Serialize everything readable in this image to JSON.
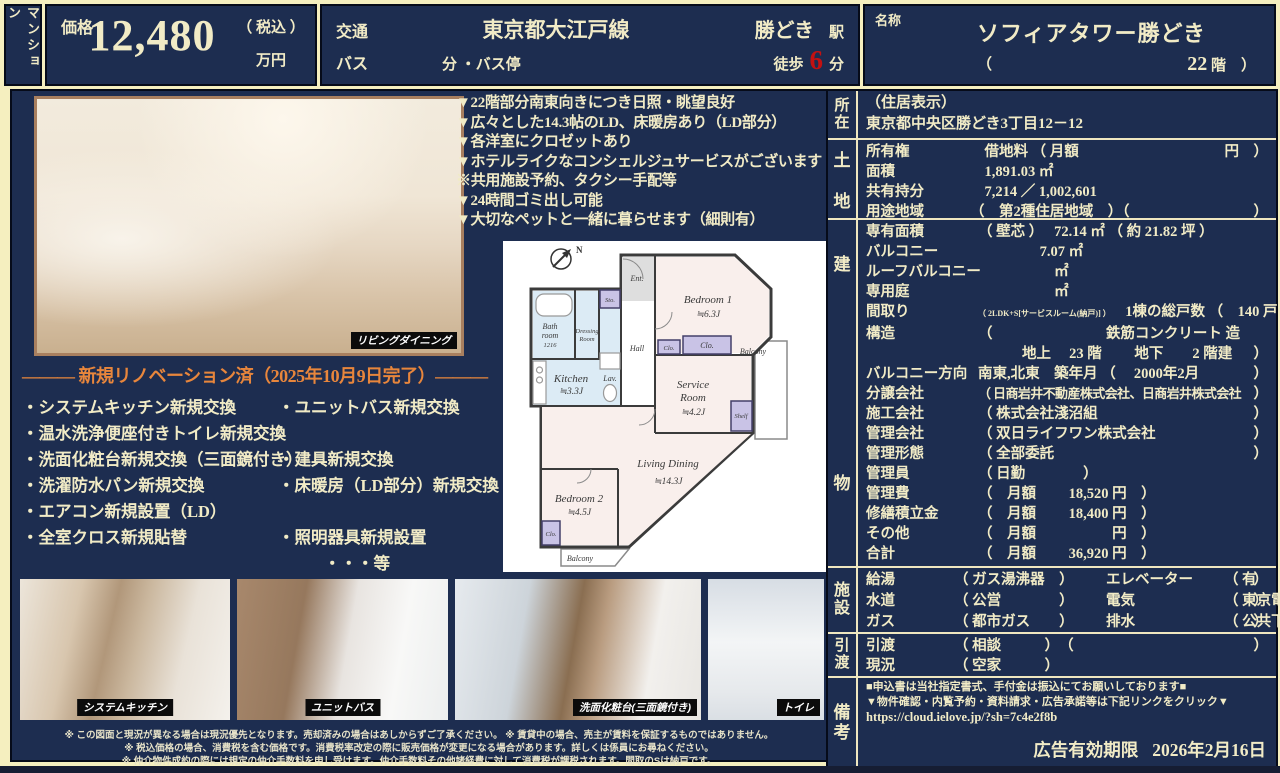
{
  "header": {
    "type_label": "マンション",
    "price": {
      "label": "価格",
      "value": "12,480",
      "tax": "（ 税込 ）",
      "unit": "万円"
    },
    "transport": {
      "label": "交通",
      "line": "東京都大江戸線",
      "station": "勝どき",
      "station_unit": "駅",
      "bus_label": "バス",
      "bus_tail": "分 ・バス停",
      "walk_label": "徒歩",
      "walk_value": "6",
      "walk_unit": "分"
    },
    "name": {
      "label": "名称",
      "value": "ソフィアタワー勝どき",
      "floor_open": "（",
      "floor_value": "22",
      "floor_unit": "階",
      "floor_close": "）"
    }
  },
  "features": [
    "▼22階部分南東向きにつき日照・眺望良好",
    "▼広々とした14.3帖のLD、床暖房あり（LD部分）",
    "▼各洋室にクロゼットあり",
    "▼ホテルライクなコンシェルジュサービスがございます",
    "※共用施設予約、タクシー手配等",
    "▼24時間ゴミ出し可能",
    "▼大切なペットと一緒に暮らせます（細則有）"
  ],
  "renovation": {
    "title": "――― 新規リノベーション済（2025年10月9日完了）―――",
    "rows": [
      {
        "l": "・システムキッチン新規交換",
        "r": "・ユニットバス新規交換"
      },
      {
        "l": "・温水洗浄便座付きトイレ新規交換",
        "r": ""
      },
      {
        "l": "・洗面化粧台新規交換（三面鏡付き）",
        "r": "・建具新規交換"
      },
      {
        "l": "・洗濯防水パン新規交換",
        "r": "・床暖房（LD部分）新規交換"
      },
      {
        "l": "・エアコン新規設置（LD）",
        "r": ""
      },
      {
        "l": "・全室クロス新規貼替",
        "r": "・照明器具新規設置"
      }
    ],
    "etc": "・・・等"
  },
  "photos": {
    "main_label": "リビングダイニング",
    "gallery": [
      "システムキッチン",
      "ユニットバス",
      "洗面化粧台(三面鏡付き)",
      "トイレ"
    ]
  },
  "floorplan": {
    "compass": "N",
    "ent": "Ent.",
    "bedroom1": "Bedroom 1",
    "bedroom1_size": "≒6.3J",
    "bath_l1": "Bath",
    "bath_l2": "room",
    "bath_size": "1216",
    "dressing_l1": "Dressing",
    "dressing_l2": "Room",
    "sto": "Sto.",
    "hall": "Hall",
    "kitchen": "Kitchen",
    "kitchen_size": "≒3.3J",
    "lav": "Lav.",
    "clo1": "Clo.",
    "clo2": "Clo.",
    "clo3": "Clo.",
    "shelf": "Shelf",
    "service_l1": "Service",
    "service_l2": "Room",
    "service_size": "≒4.2J",
    "balcony_right": "Balcony",
    "balcony_bottom": "Balcony",
    "living": "Living Dining",
    "living_size": "≒14.3J",
    "bedroom2": "Bedroom 2",
    "bedroom2_size": "≒4.5J"
  },
  "details": {
    "location": {
      "label": "所在",
      "line1": "（住居表示）",
      "line2": "東京都中央区勝どき3丁目12－12"
    },
    "land": {
      "label": "土地",
      "rows": [
        {
          "k": "所有権",
          "v": "　借地料 （ 月額",
          "t": "円　）"
        },
        {
          "k": "面積",
          "v": "　1,891.03 ㎡",
          "t": ""
        },
        {
          "k": "共有持分",
          "v": "　7,214 ／ 1,002,601",
          "t": ""
        },
        {
          "k": "用途地域",
          "v": "（　第2種住居地域　）（",
          "t": "）"
        }
      ]
    },
    "building": {
      "label": "建物",
      "rows": [
        {
          "k": "専有面積",
          "s": "",
          "v": "（ 壁芯 ）　 72.14 ㎡ （ 約 21.82 坪 ）",
          "t": ""
        },
        {
          "k": "バルコニー",
          "s": "",
          "v": "　　　　 7.07 ㎡",
          "t": ""
        },
        {
          "k": "ルーフバルコニー",
          "s": "",
          "v": "　　　　　 ㎡",
          "t": ""
        },
        {
          "k": "専用庭",
          "s": "",
          "v": "　　　　　 ㎡",
          "t": ""
        },
        {
          "k": "間取り",
          "s": "（ 2LDK+S[サービスルーム(納戸)] ）",
          "v": "　1棟の総戸数 （　140 戸　）",
          "t": ""
        },
        {
          "k": "構造",
          "v": "（",
          "v2": "鉄筋コンクリート 造",
          "t": ""
        },
        {
          "k": "",
          "s": "",
          "v": "地上　 23 階　　 地下　　2 階建",
          "t": "）"
        },
        {
          "k": "バルコニー方向",
          "s": "",
          "v": "南東,北東　築年月 （　 2000年2月",
          "t": "）"
        },
        {
          "k": "分譲会社",
          "s": "",
          "v": "（ 日商岩井不動産株式会社、日商岩井株式会社",
          "t": "）"
        },
        {
          "k": "施工会社",
          "s": "",
          "v": "（ 株式会社淺沼組",
          "t": "）"
        },
        {
          "k": "管理会社",
          "s": "",
          "v": "（ 双日ライフワン株式会社",
          "t": "）"
        },
        {
          "k": "管理形態",
          "s": "",
          "v": "（ 全部委託",
          "t": "）"
        },
        {
          "k": "管理員",
          "s": "",
          "v": "（ 日勤　　　　）",
          "t": ""
        },
        {
          "k": "管理費",
          "s": "",
          "v": "（　月額　　 18,520 円　）",
          "t": ""
        },
        {
          "k": "修繕積立金",
          "s": "",
          "v": "（　月額　　 18,400 円　）",
          "t": ""
        },
        {
          "k": "その他",
          "s": "",
          "v": "（　月額　　　　　 円　）",
          "t": ""
        },
        {
          "k": "合計",
          "s": "",
          "v": "（　月額　　 36,920 円　）",
          "t": ""
        }
      ]
    },
    "facilities": {
      "label": "施設",
      "rows": [
        {
          "k1": "給湯",
          "v1": "（ ガス湯沸器　）",
          "k2": "エレベーター",
          "v2": "（ 有",
          "t": "）"
        },
        {
          "k1": "水道",
          "v1": "（ 公営　　　　）",
          "k2": "電気",
          "v2": "（ 東京電力",
          "t": "）"
        },
        {
          "k1": "ガス",
          "v1": "（ 都市ガス　　）",
          "k2": "排水",
          "v2": "（ 公共下水",
          "t": "）"
        }
      ]
    },
    "handover": {
      "label": "引渡",
      "rows": [
        {
          "k": "引渡",
          "v": "（ 相談　　　）　（",
          "t": "）"
        },
        {
          "k": "現況",
          "v": "（ 空家　　　）",
          "t": ""
        }
      ]
    },
    "remarks": {
      "label": "備考",
      "line1": "■申込書は当社指定書式、手付金は振込にてお願いしております■",
      "line2": "▼物件確認・内覧予約・資料請求・広告承諾等は下記リンクをクリック▼",
      "url": "https://cloud.ielove.jp/?sh=7c4e2f8b",
      "validity_label": "広告有効期限",
      "validity_date": "2026年2月16日"
    }
  },
  "disclaimers": [
    "※ この図面と現況が異なる場合は現況優先となります。売却済みの場合はあしからずご了承ください。 ※ 賃貸中の場合、売主が賃料を保証するものではありません。",
    "※ 税込価格の場合、消費税を含む価格です。消費税率改定の際に販売価格が変更になる場合があります。詳しくは係員にお尋ねください。",
    "※ 仲介物件成約の際には規定の仲介手数料を申し受けます。仲介手数料その他諸経費に対して消費税が課税されます。間取のSは納戸です。"
  ]
}
